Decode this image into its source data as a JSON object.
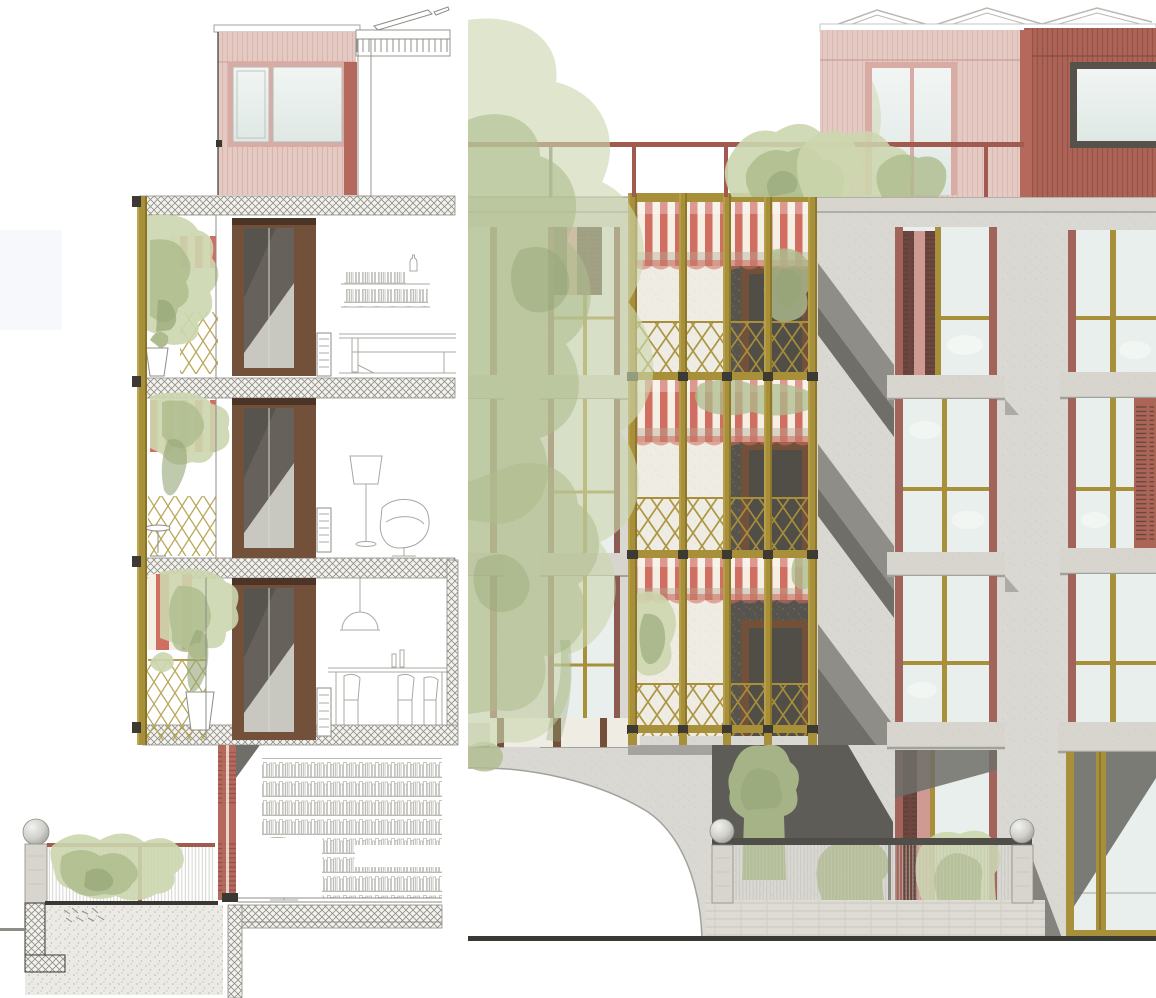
{
  "meta": {
    "title": "Residential building — facade section and street elevation",
    "description": "Architectural drawing: left, a vertical section through the balcony facade with three floors, striped awnings, gold trellis, plants and sketched furniture over a garden-level library; right, the street elevation with a stone facade, gold espalier balcony bay, red striped awnings, louvered folding shutters, rooftop pavilions in pink and oxide red, a roof terrace railing with shrubs, an arched passage, a garden fence with sphere finials and a large street tree."
  },
  "palette": {
    "paper": "#ffffff",
    "faint-band": "#f7f8fc",
    "line-dark": "#3a3833",
    "line-mid": "#8d8c86",
    "line-light": "#b9b8b2",
    "furniture-line": "#a9a8a2",
    "slab-hatch-bg": "#f3f2ed",
    "slab-hatch-line": "#8e8d87",
    "concrete-bg": "#eceae5",
    "concrete-dot": "#b9b7b0",
    "facade": "#d9d8d3",
    "facade-speckle": "#c6c5bf",
    "ledge": "#d7d5ce",
    "ledge-shadow": "#a3a19b",
    "shadow-mid": "#8e8d88",
    "shadow-dark": "#6f6e68",
    "recess-dark": "#5e5c56",
    "glass-light": "#e9efec",
    "glass-cloud": "#f8fbf9",
    "glass-dark": "#66625b",
    "glass-deep": "#57544d",
    "glass-mid": "#a7a49c",
    "glass-pale": "#c9c8c0",
    "gold": "#a8903a",
    "gold-light": "#c4ae58",
    "gold-dark": "#7c671f",
    "awning-red": "#cf6e61",
    "awning-cream": "#f4eee3",
    "awning-shade": "#b4a995",
    "brown-frame": "#73503a",
    "brown-dark": "#4c3526",
    "pink-siding": "#e5c9c3",
    "pink-stripe": "#d6b3ac",
    "pink-frame": "#d8aca4",
    "red-siding": "#ac6457",
    "red-stripe": "#934f44",
    "red-accent": "#b5685c",
    "rail-red": "#a05a50",
    "shutter-dark": "#7e5148",
    "shutter-pink": "#cf9a92",
    "green-light": "#ccd6ae",
    "green-mid": "#aebc8d",
    "green-dark": "#95a576",
    "stone-post": "#d8d5ce",
    "base-wall": "#dedbd4",
    "base-joint": "#c9c6bf",
    "mesh-line": "#c6c4bc",
    "sphere-hi": "#f2f2f0",
    "sphere-lo": "#96968f",
    "book-line": "#bcbbb5",
    "white-wall": "#efece3",
    "dark-node": "#3c3a33"
  },
  "scene": {
    "views": [
      {
        "id": "section",
        "floors": 3,
        "features": [
          "gold balcony post",
          "striped awnings",
          "trellis railing",
          "planters and vines",
          "glass doors with shade",
          "bookshelf, sofa, lamp, dining furniture sketches",
          "garden-level library wall",
          "retaining wall, planter fence with sphere finial"
        ]
      },
      {
        "id": "elevation",
        "floors": 4,
        "features": [
          "speckled stone facade",
          "four-bay gold espalier balcony",
          "red-white awnings per floor",
          "windows with gold transoms",
          "folding louvered shutters",
          "pink and oxide-red roof pavilions",
          "roof railing with shrubs",
          "arched passage",
          "baluster fence with sphere finials",
          "street tree wash"
        ]
      }
    ]
  }
}
